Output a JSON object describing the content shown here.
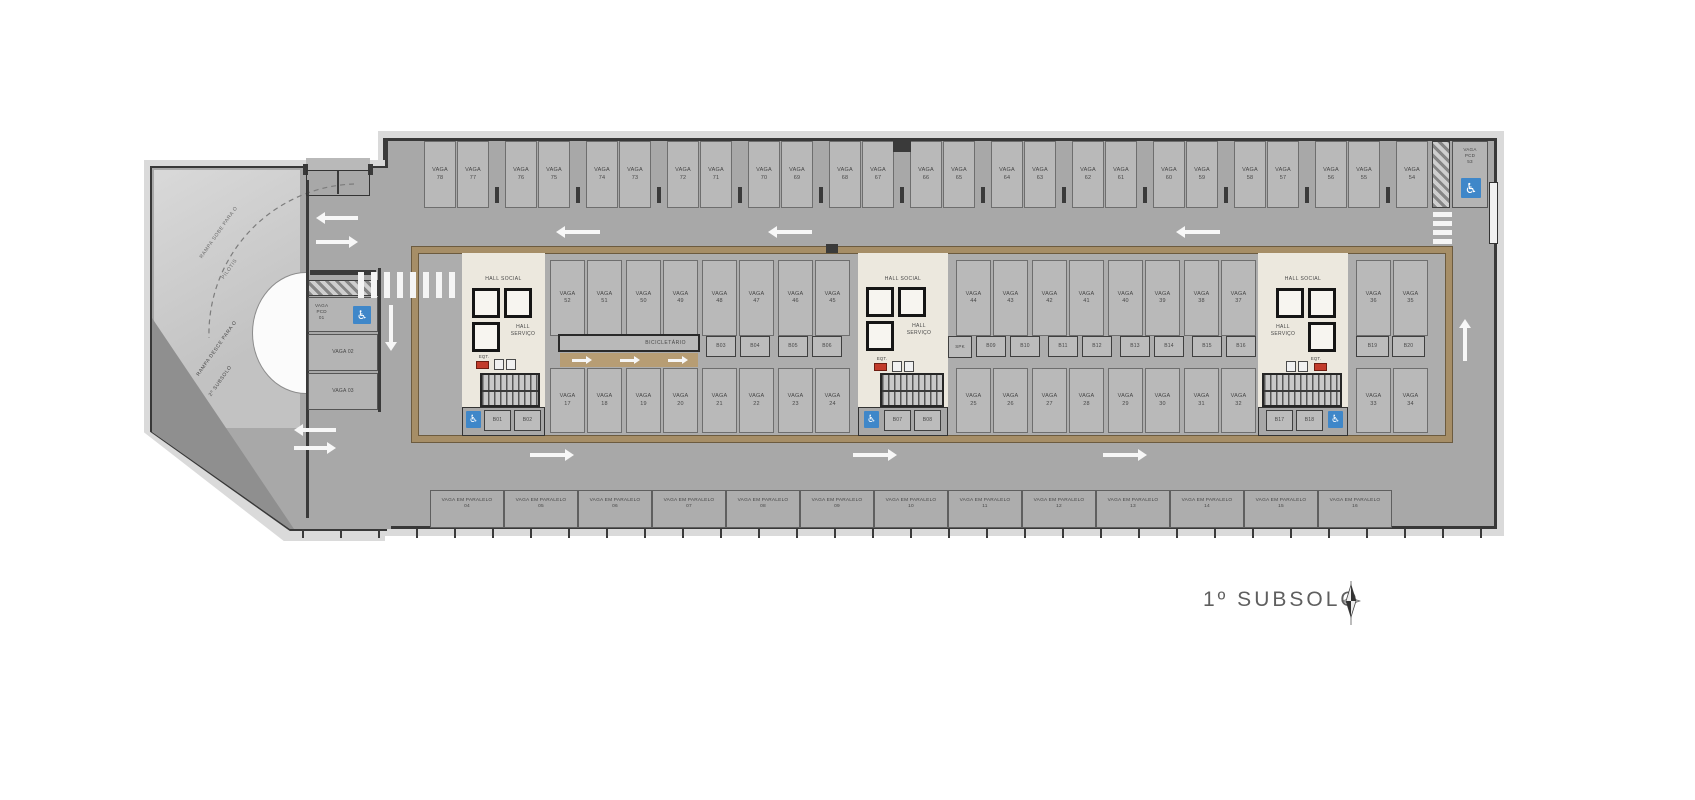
{
  "floor": {
    "title": "1º SUBSOLO"
  },
  "words": {
    "vaga": "VAGA",
    "hall_social": "HALL SOCIAL",
    "hall_servico_lines": [
      "HALL",
      "SERVIÇO"
    ],
    "bicicletario": "BICICLETÁRIO",
    "spk": "SPK",
    "eqt": "EQT.",
    "parallel": "VAGA EM PARALELO"
  },
  "ramps": {
    "up_lines": [
      "RAMPA SOBE PARA O",
      "PILOTIS"
    ],
    "down_lines": [
      "RAMPA DESCE PARA O",
      "2º SUBSOLO"
    ]
  },
  "top_row": {
    "numbers": [
      "78",
      "77",
      "76",
      "75",
      "74",
      "73",
      "72",
      "71",
      "70",
      "69",
      "68",
      "67",
      "66",
      "65",
      "64",
      "63",
      "62",
      "61",
      "60",
      "59",
      "58",
      "57",
      "56",
      "55",
      "54"
    ],
    "pcd_lines": [
      "VAGA",
      "PCD",
      "53"
    ]
  },
  "band": {
    "upper_groups": [
      [
        "52",
        "51",
        "50",
        "49",
        "48",
        "47",
        "46",
        "45"
      ],
      [
        "44",
        "43",
        "42",
        "41",
        "40",
        "39",
        "38",
        "37"
      ],
      [
        "36",
        "35"
      ]
    ],
    "lower_groups": [
      [
        "17",
        "18",
        "19",
        "20",
        "21",
        "22",
        "23",
        "24"
      ],
      [
        "25",
        "26",
        "27",
        "28",
        "29",
        "30",
        "31",
        "32"
      ],
      [
        "33",
        "34"
      ]
    ],
    "mid_boxes_left": [
      "B03",
      "B04",
      "B05",
      "B06"
    ],
    "mid_boxes_right": [
      "B09",
      "B10",
      "B11",
      "B12",
      "B13",
      "B14",
      "B15",
      "B16"
    ],
    "mid_boxes_end": [
      "B19",
      "B20"
    ],
    "core_boxes": [
      [
        "B01",
        "B02"
      ],
      [
        "B07",
        "B08"
      ],
      [
        "B17",
        "B18"
      ]
    ]
  },
  "left_area": {
    "pcd_lines": [
      "VAGA",
      "PCD",
      "01"
    ],
    "stall_02": "VAGA 02",
    "stall_03": "VAGA 03"
  },
  "parallel_numbers": [
    "04",
    "05",
    "06",
    "07",
    "08",
    "09",
    "10",
    "11",
    "12",
    "13",
    "14",
    "15",
    "16"
  ],
  "colors": {
    "pcd_blue": "#3f87c9",
    "wall_brown": "#a68e67",
    "eqt_red": "#c23b2b",
    "floor_gray": "#a8a8a8",
    "core_cream": "#ece8de"
  }
}
